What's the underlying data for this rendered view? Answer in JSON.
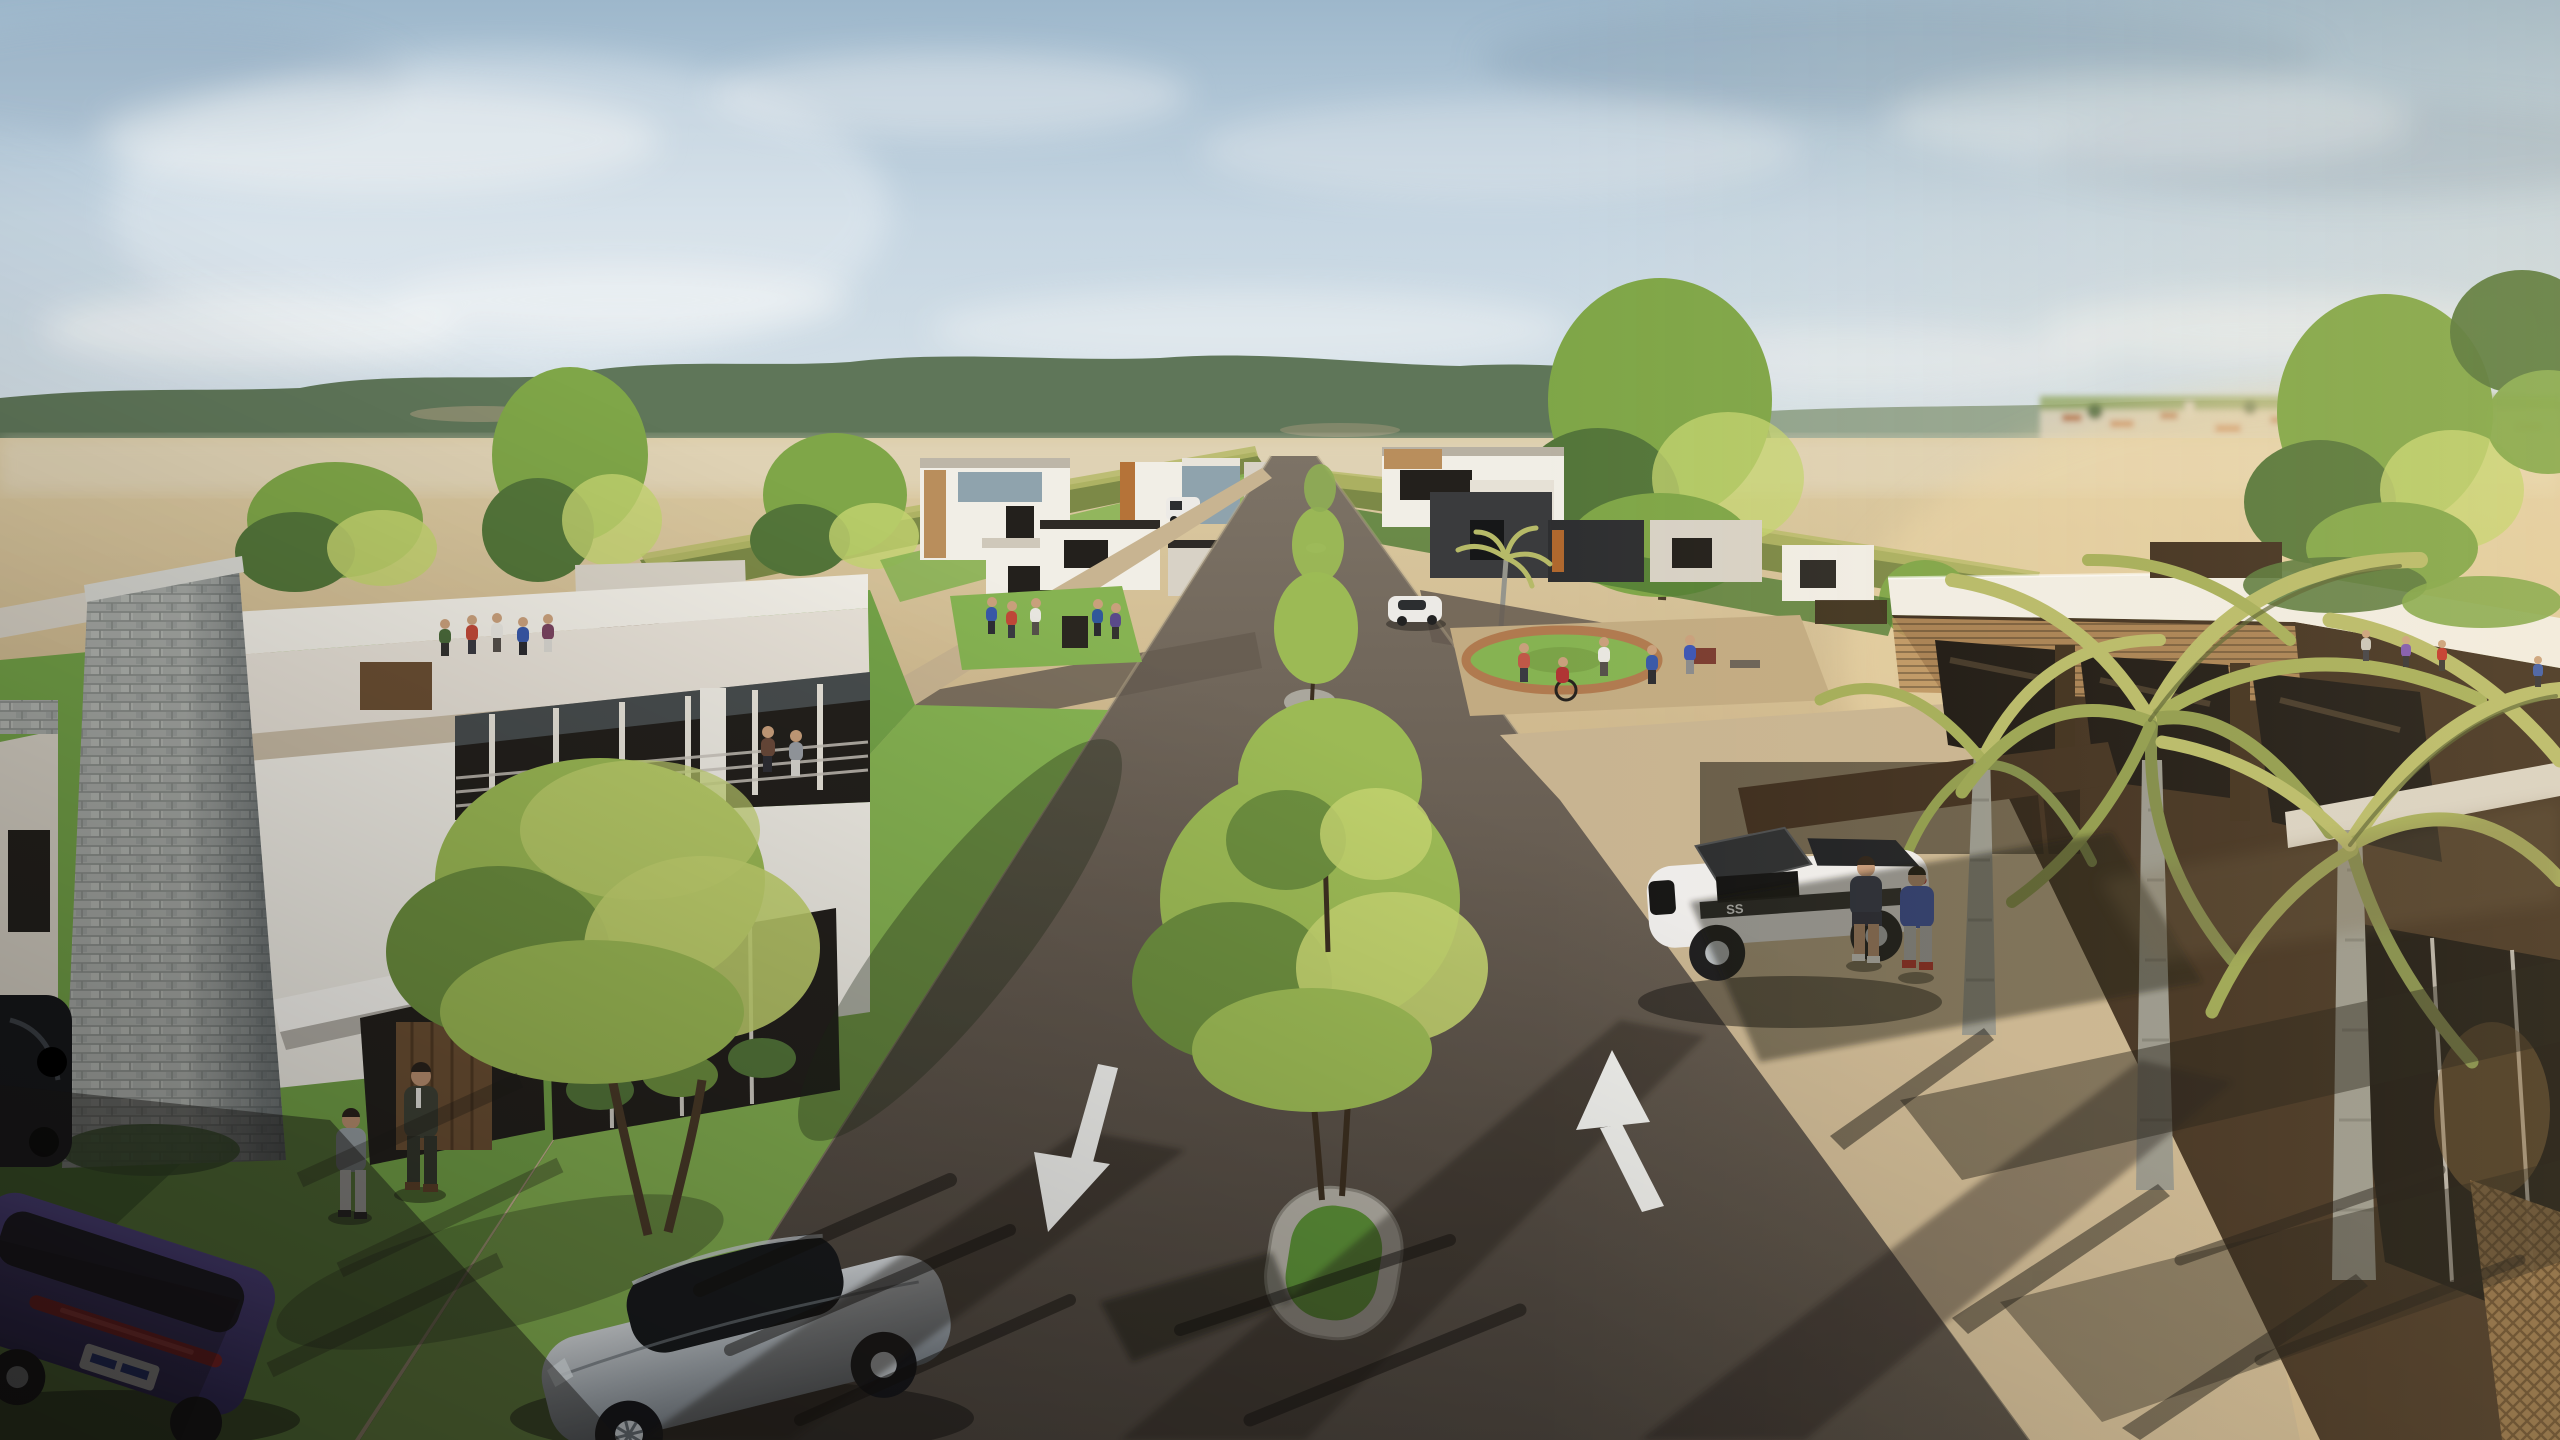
{
  "meta": {
    "title": "3D architectural render: tree-lined boulevard of a modern residential development at golden hour",
    "view": "elevated three-quarter aerial perspective",
    "badge_ss": "SS"
  },
  "palette": {
    "sky-top": "#9db7cb",
    "sky-mid": "#c6d6e2",
    "sky-low": "#e6eae4",
    "cloud": "#f4f6f6",
    "hill-dark": "#5f7659",
    "hill-light": "#8ea08a",
    "village-wall": "#d8d2c2",
    "village-roof": "#b06f48",
    "field-green": "#8ca45e",
    "sand-far": "#dbcaa2",
    "sand-near": "#c2a47b",
    "sand-bright": "#ecd7a8",
    "road-lit": "#7d7366",
    "road-mid": "#655b50",
    "road-dark": "#3f3933",
    "walk-lit": "#c8b491",
    "walk-shade": "#8f8067",
    "grass-lit": "#86b352",
    "grass-mid": "#74a348",
    "grass-dark": "#4f7a33",
    "grass-median": "#5c9038",
    "stone-light": "#a8aba7",
    "stone-joint": "#878b87",
    "white-wall": "#f1eee6",
    "white-shade": "#d8d2c6",
    "tan-band": "#c9bca6",
    "glass-dark": "#23201c",
    "glass-blue": "#8fa3ad",
    "wood": "#6b4f33",
    "wood-dark": "#3c2c1d",
    "wood-lit": "#b98e5c",
    "palm-leaf": "#b6ba68",
    "palm-leaf-dark": "#7c8947",
    "palm-trunk": "#95958c",
    "tree-green": "#7fa648",
    "tree-lit": "#c4d470",
    "tree-dark": "#54763a",
    "treey-core": "#9cba55",
    "car-silver": "#a9b0b6",
    "car-purple": "#4c3d9a",
    "car-white": "#eceae6",
    "car-black": "#17181b",
    "arrow-white": "#f2f2ef"
  },
  "scene": {
    "sky": {
      "clouds": "soft hazy cloud bands",
      "light": "low warm sun from the right"
    },
    "background": {
      "hills": "forested ridge across the horizon",
      "village": "distant town with orange roofs and green fields at right",
      "terrain": "open sandy plain behind the development"
    },
    "avenue": {
      "orientation": "recedes to center vanishing point",
      "median": "oblong pebble-stone planters with young yellow-green trees",
      "lane_markings": [
        "down-left arrow (near lane)",
        "up arrow (far lane)"
      ]
    },
    "vehicles": [
      {
        "name": "silver-coupe",
        "position": "foreground center-left, driving toward viewer"
      },
      {
        "name": "purple-suv",
        "position": "parked bottom-left curb"
      },
      {
        "name": "black-car",
        "position": "parked left edge"
      },
      {
        "name": "white-muscle-car",
        "badge": "SS",
        "state": "hood open, parked under canopy at right"
      },
      {
        "name": "white-hatchback-distant",
        "position": "driving on avenue mid-distance"
      },
      {
        "name": "white-van-distant",
        "position": "parked by distant left-row houses"
      }
    ],
    "people_groups": [
      {
        "name": "sidewalk-pair",
        "where": "left sidewalk",
        "count": 2,
        "note": "man in dark suit with companion"
      },
      {
        "name": "plaza-a-group",
        "where": "small plaza behind left house",
        "count": 5
      },
      {
        "name": "lawn-kiosk-group",
        "where": "left-row park lawn",
        "count": 5
      },
      {
        "name": "roundabout-group",
        "where": "right plaza roundabout",
        "count": 5,
        "note": "includes wheelchair user"
      },
      {
        "name": "car-pair",
        "where": "beside white muscle car",
        "count": 2,
        "note": "blue sweater + red shoes"
      },
      {
        "name": "courtyard-group",
        "where": "right building courtyard",
        "count": 4
      }
    ],
    "buildings": [
      {
        "name": "left-villa",
        "style": "two-story white modern house with stacked-stone tower, glass balcony, wood entry door"
      },
      {
        "name": "left-row-houses",
        "style": "receding row of flat-roof modern houses with wood / blue-glass accents"
      },
      {
        "name": "right-row-houses",
        "style": "white + charcoal modern boxes across the avenue"
      },
      {
        "name": "right-pavilion",
        "style": "dark timber-and-glass building with white parapet, carport canopy and palms"
      }
    ],
    "vegetation": [
      "green street trees",
      "yellow-green median trees",
      "long yellow-green hedges",
      "three tall palms with arching fronds",
      "bright lawn panels"
    ]
  }
}
